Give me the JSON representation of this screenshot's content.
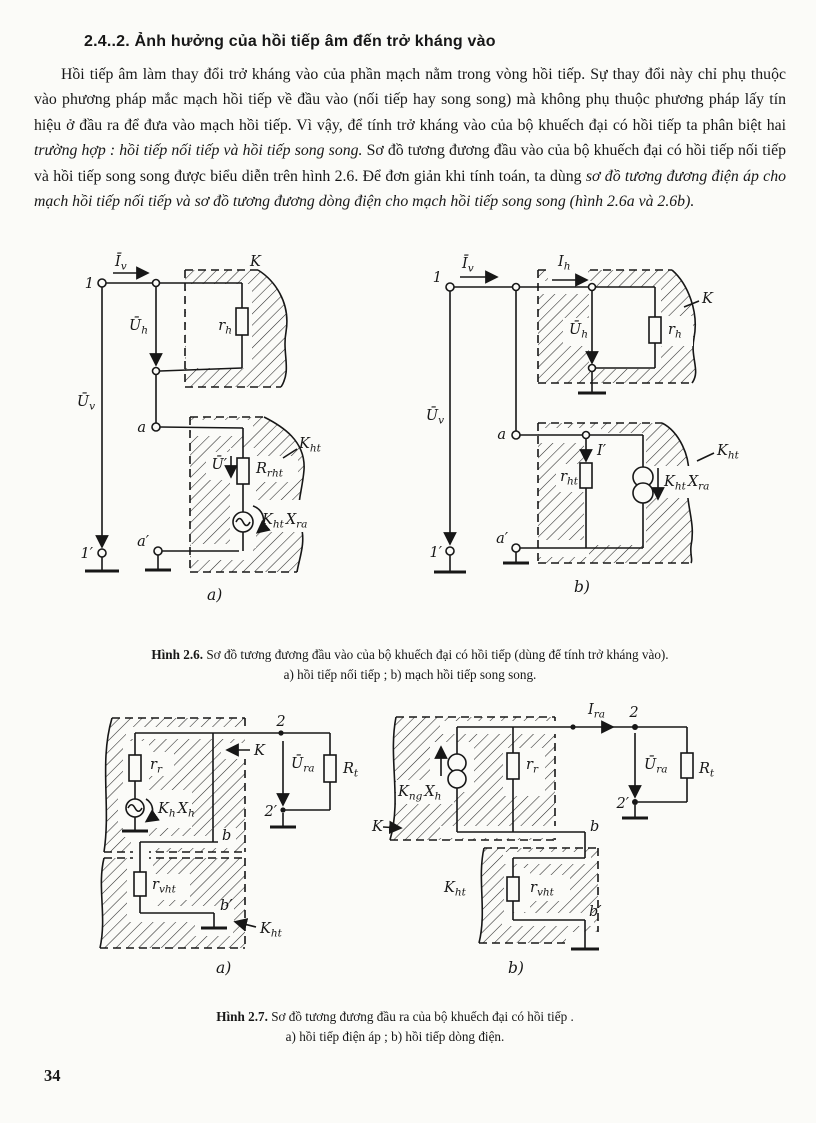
{
  "ink": "#171717",
  "paper": "#fbfbf8",
  "page": {
    "number": "34",
    "heading": "2.4..2. Ảnh hưởng của hồi tiếp âm đến trở kháng vào",
    "paragraph": {
      "run0": "Hồi tiếp âm làm thay đổi trở kháng vào của phần mạch nằm trong vòng hồi tiếp. Sự thay đổi này chỉ phụ thuộc vào phương pháp mắc mạch hồi tiếp về đầu vào (nối tiếp hay song song) mà không phụ thuộc phương pháp lấy tín hiệu ở đầu ra để đưa vào mạch hồi tiếp. Vì vậy, để tính trở kháng vào của bộ khuếch đại có hồi tiếp ta phân biệt hai ",
      "run1": "trường hợp : hồi tiếp nối tiếp và hồi tiếp song song.",
      "run2": " Sơ đồ tương đương đầu vào của bộ khuếch đại có hồi tiếp nối tiếp và hồi tiếp song song được biểu diễn trên hình 2.6. Để đơn giản khi tính toán, ta dùng ",
      "run3": "sơ đồ tương đương điện áp cho mạch hồi tiếp nối tiếp và sơ đồ tương đương dòng điện cho mạch hồi tiếp song song (hình 2.6a và 2.6b)."
    }
  },
  "figure26": {
    "caption": {
      "bold": "Hình 2.6.",
      "text": " Sơ đồ tương đương đầu vào của bộ khuếch đại có hồi tiếp (dùng để tính trở kháng vào).",
      "line2": "a) hồi tiếp nối tiếp ; b) mạch hồi tiếp song song."
    },
    "a": {
      "iv": {
        "b": "Ī",
        "s": "v"
      },
      "n1": "1",
      "n1p": "1′",
      "uh": {
        "b": "Ū",
        "s": "h"
      },
      "uv": {
        "b": "Ū",
        "s": "v"
      },
      "k": "K",
      "rh": {
        "b": "r",
        "s": "h"
      },
      "a": "a",
      "ap": "a′",
      "up": "Ū′",
      "rrht": {
        "b": "R",
        "s": "rht"
      },
      "kht": {
        "b": "K",
        "s": "ht"
      },
      "khtxra": {
        "b1": "K",
        "s1": "ht",
        "b2": "X",
        "s2": "ra"
      },
      "cap": "a)"
    },
    "b": {
      "iv": {
        "b": "Ī",
        "s": "v"
      },
      "ih": {
        "b": "I",
        "s": "h"
      },
      "n1": "1",
      "n1p": "1′",
      "uh": {
        "b": "Ū",
        "s": "h"
      },
      "rh": {
        "b": "r",
        "s": "h"
      },
      "k": "K",
      "uv": {
        "b": "Ū",
        "s": "v"
      },
      "a": "a",
      "ap": "a′",
      "ip": "I′",
      "rht": {
        "b": "r",
        "s": "ht"
      },
      "khtxra": {
        "b1": "K",
        "s1": "ht",
        "b2": "X",
        "s2": "ra"
      },
      "kht": {
        "b": "K",
        "s": "ht"
      },
      "cap": "b)"
    }
  },
  "figure27": {
    "caption": {
      "bold": "Hình 2.7.",
      "text": " Sơ đồ tương đương đầu ra của bộ khuếch đại có hồi tiếp .",
      "line2": "a) hồi tiếp điện áp ; b) hồi tiếp dòng điện."
    },
    "a": {
      "rr": {
        "b": "r",
        "s": "r"
      },
      "khxh": {
        "b1": "K",
        "s1": "h",
        "b2": "X",
        "s2": "h"
      },
      "k": "K",
      "n2": "2",
      "n2p": "2′",
      "ura": {
        "b": "Ū",
        "s": "ra"
      },
      "rt": {
        "b": "R",
        "s": "t"
      },
      "b": "b",
      "bp": "b′",
      "rvht": {
        "b": "r",
        "s": "vht"
      },
      "kht": {
        "b": "K",
        "s": "ht"
      },
      "cap": "a)"
    },
    "b": {
      "kngxh": {
        "b1": "K",
        "s1": "ng",
        "b2": "X",
        "s2": "h"
      },
      "rr": {
        "b": "r",
        "s": "r"
      },
      "ira": {
        "b": "I",
        "s": "ra"
      },
      "n2": "2",
      "n2p": "2′",
      "ura": {
        "b": "Ū",
        "s": "ra"
      },
      "rt": {
        "b": "R",
        "s": "t"
      },
      "k": "K",
      "b": "b",
      "bp": "b′",
      "kht": {
        "b": "K",
        "s": "ht"
      },
      "rvht": {
        "b": "r",
        "s": "vht"
      },
      "cap": "b)"
    }
  }
}
